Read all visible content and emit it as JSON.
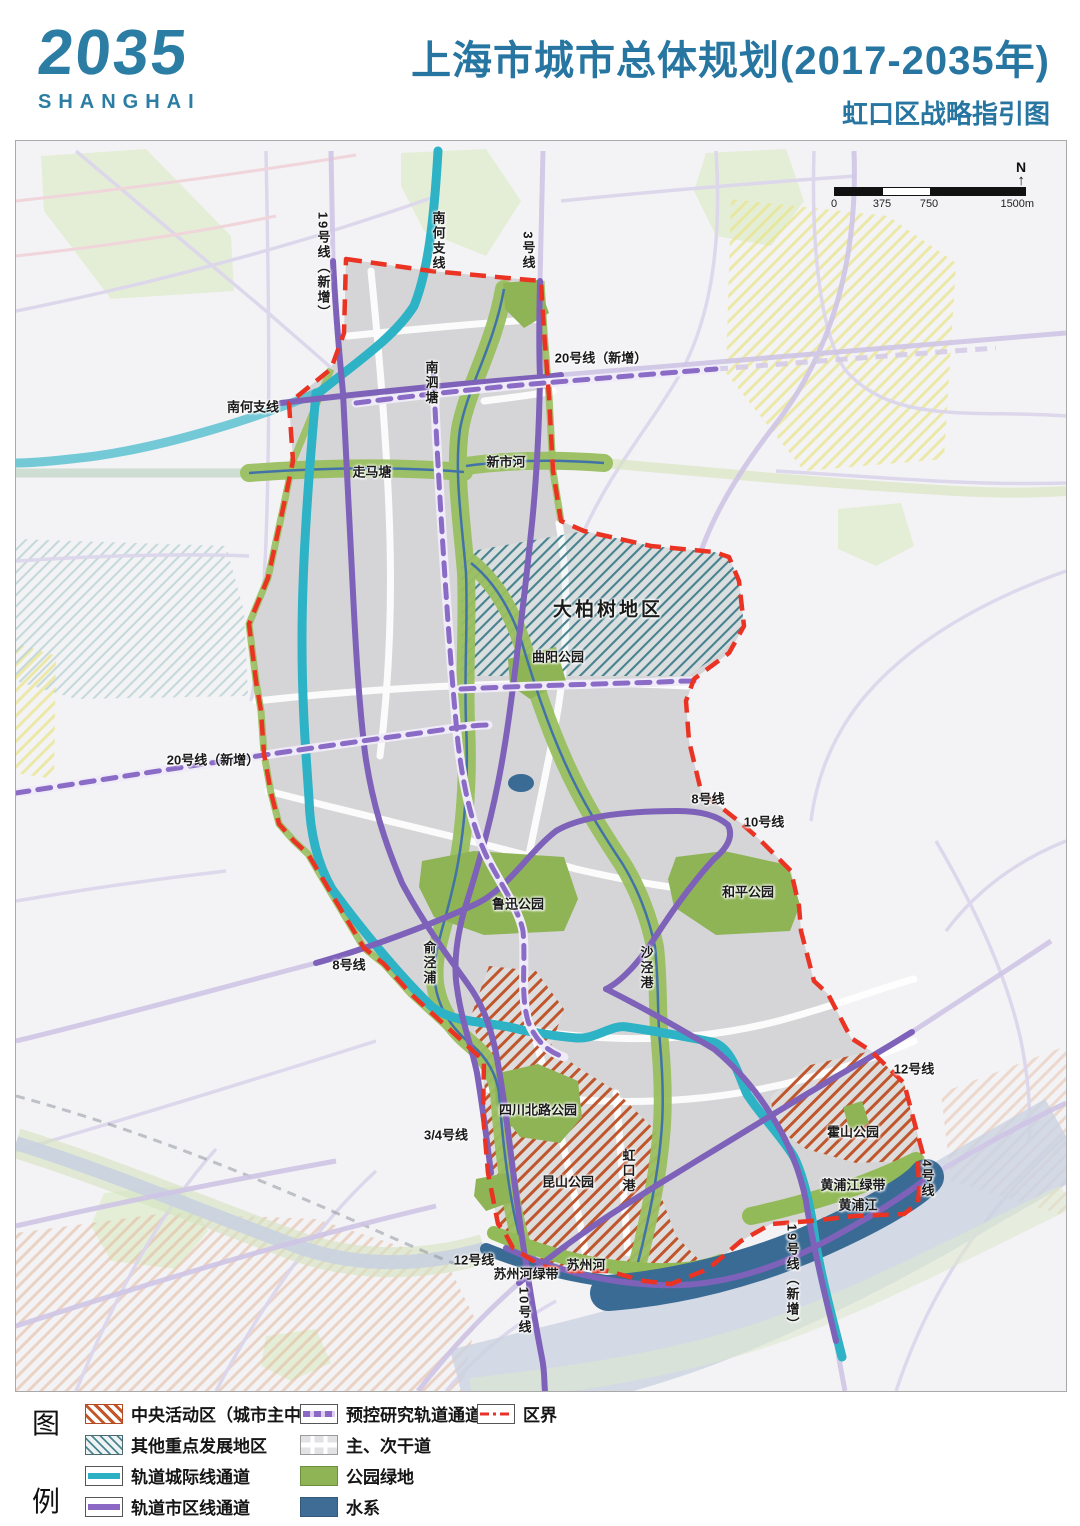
{
  "header": {
    "logo_year": "2035",
    "logo_city": "SHANGHAI",
    "title": "上海市城市总体规划(2017-2035年)",
    "subtitle": "虹口区战略指引图"
  },
  "map": {
    "north_label": "N",
    "scale_bar": {
      "ticks": [
        "0",
        "375",
        "750",
        "1500m"
      ]
    },
    "labels": [
      {
        "text": "19号线（新增）",
        "x": 307,
        "y": 125,
        "v": 1
      },
      {
        "text": "南何支线",
        "x": 422,
        "y": 100,
        "v": 1
      },
      {
        "text": "3号线",
        "x": 512,
        "y": 110,
        "v": 1
      },
      {
        "text": "20号线（新增）",
        "x": 585,
        "y": 216
      },
      {
        "text": "南何支线",
        "x": 237,
        "y": 265
      },
      {
        "text": "南泗塘",
        "x": 415,
        "y": 242,
        "v": 1
      },
      {
        "text": "走马塘",
        "x": 356,
        "y": 330
      },
      {
        "text": "新市河",
        "x": 490,
        "y": 320
      },
      {
        "text": "大柏树地区",
        "x": 592,
        "y": 467,
        "big": 1
      },
      {
        "text": "曲阳公园",
        "x": 542,
        "y": 515
      },
      {
        "text": "20号线（新增）",
        "x": 197,
        "y": 618
      },
      {
        "text": "8号线",
        "x": 692,
        "y": 657
      },
      {
        "text": "10号线",
        "x": 748,
        "y": 680
      },
      {
        "text": "和平公园",
        "x": 732,
        "y": 750
      },
      {
        "text": "鲁迅公园",
        "x": 502,
        "y": 762
      },
      {
        "text": "俞泾浦",
        "x": 413,
        "y": 822,
        "v": 1
      },
      {
        "text": "沙泾港",
        "x": 630,
        "y": 827,
        "v": 1
      },
      {
        "text": "8号线",
        "x": 333,
        "y": 823
      },
      {
        "text": "12号线",
        "x": 898,
        "y": 927
      },
      {
        "text": "四川北路公园",
        "x": 522,
        "y": 968
      },
      {
        "text": "3/4号线",
        "x": 430,
        "y": 993
      },
      {
        "text": "霍山公园",
        "x": 837,
        "y": 990
      },
      {
        "text": "昆山公园",
        "x": 552,
        "y": 1040
      },
      {
        "text": "虹口港",
        "x": 612,
        "y": 1030,
        "v": 1
      },
      {
        "text": "黄浦江绿带",
        "x": 837,
        "y": 1043
      },
      {
        "text": "黄浦江",
        "x": 842,
        "y": 1063
      },
      {
        "text": "4号线",
        "x": 911,
        "y": 1038,
        "v": 1
      },
      {
        "text": "12号线",
        "x": 458,
        "y": 1118
      },
      {
        "text": "苏州河绿带",
        "x": 510,
        "y": 1132
      },
      {
        "text": "苏州河",
        "x": 570,
        "y": 1123
      },
      {
        "text": "10号线",
        "x": 508,
        "y": 1170,
        "v": 1
      },
      {
        "text": "19号线（新增）",
        "x": 776,
        "y": 1137,
        "v": 1
      }
    ]
  },
  "legend": {
    "title_chars": [
      "图",
      "例"
    ],
    "columns": [
      {
        "items": [
          {
            "label": "中央活动区（城市主中心）",
            "swatch": "hatch-orange"
          },
          {
            "label": "其他重点发展地区",
            "swatch": "hatch-teal"
          },
          {
            "label": "轨道城际线通道",
            "swatch": "line-cyan"
          },
          {
            "label": "轨道市区线通道",
            "swatch": "line-purple"
          }
        ]
      },
      {
        "items": [
          {
            "label": "预控研究轨道通道",
            "swatch": "line-purple-dashed"
          },
          {
            "label": "主、次干道",
            "swatch": "road"
          },
          {
            "label": "公园绿地",
            "swatch": "fill-green"
          },
          {
            "label": "水系",
            "swatch": "fill-blue"
          }
        ]
      },
      {
        "items": [
          {
            "label": "区界",
            "swatch": "line-red-dashed"
          }
        ]
      }
    ]
  },
  "colors": {
    "accent_teal": "#2b7da4",
    "boundary_red": "#ea3323",
    "park_green": "#8fb455",
    "water_blue": "#3e6c94",
    "rail_cyan": "#2cb1c4",
    "metro_purple": "#8a68c4",
    "caz_orange": "#c4562a",
    "key_area_teal": "#4a8691"
  }
}
